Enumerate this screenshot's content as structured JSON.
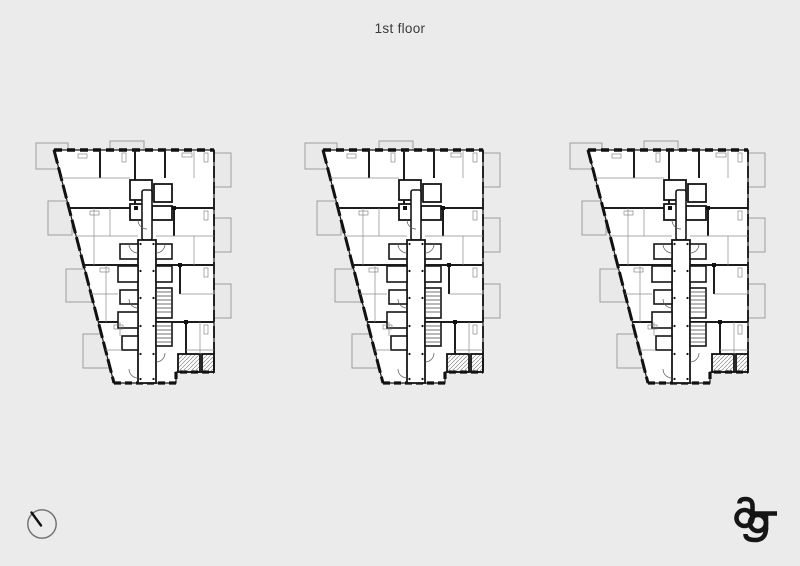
{
  "page": {
    "title": "1st floor",
    "background_color": "#ebebeb"
  },
  "plans": {
    "count": 3,
    "items": [
      {
        "label": "floor plan (left)"
      },
      {
        "label": "floor plan (center)"
      },
      {
        "label": "floor plan (right)"
      }
    ]
  },
  "footer": {
    "compass_icon": "north-arrow-circle",
    "logo_icon": "ag-monogram"
  },
  "colors": {
    "wall": "#1a1a1a",
    "plan_fill": "#ffffff",
    "partition": "#8b8b8b",
    "balcony_outline": "#9d9d9d",
    "title_text": "#3a3a3a",
    "logo": "#151515"
  }
}
